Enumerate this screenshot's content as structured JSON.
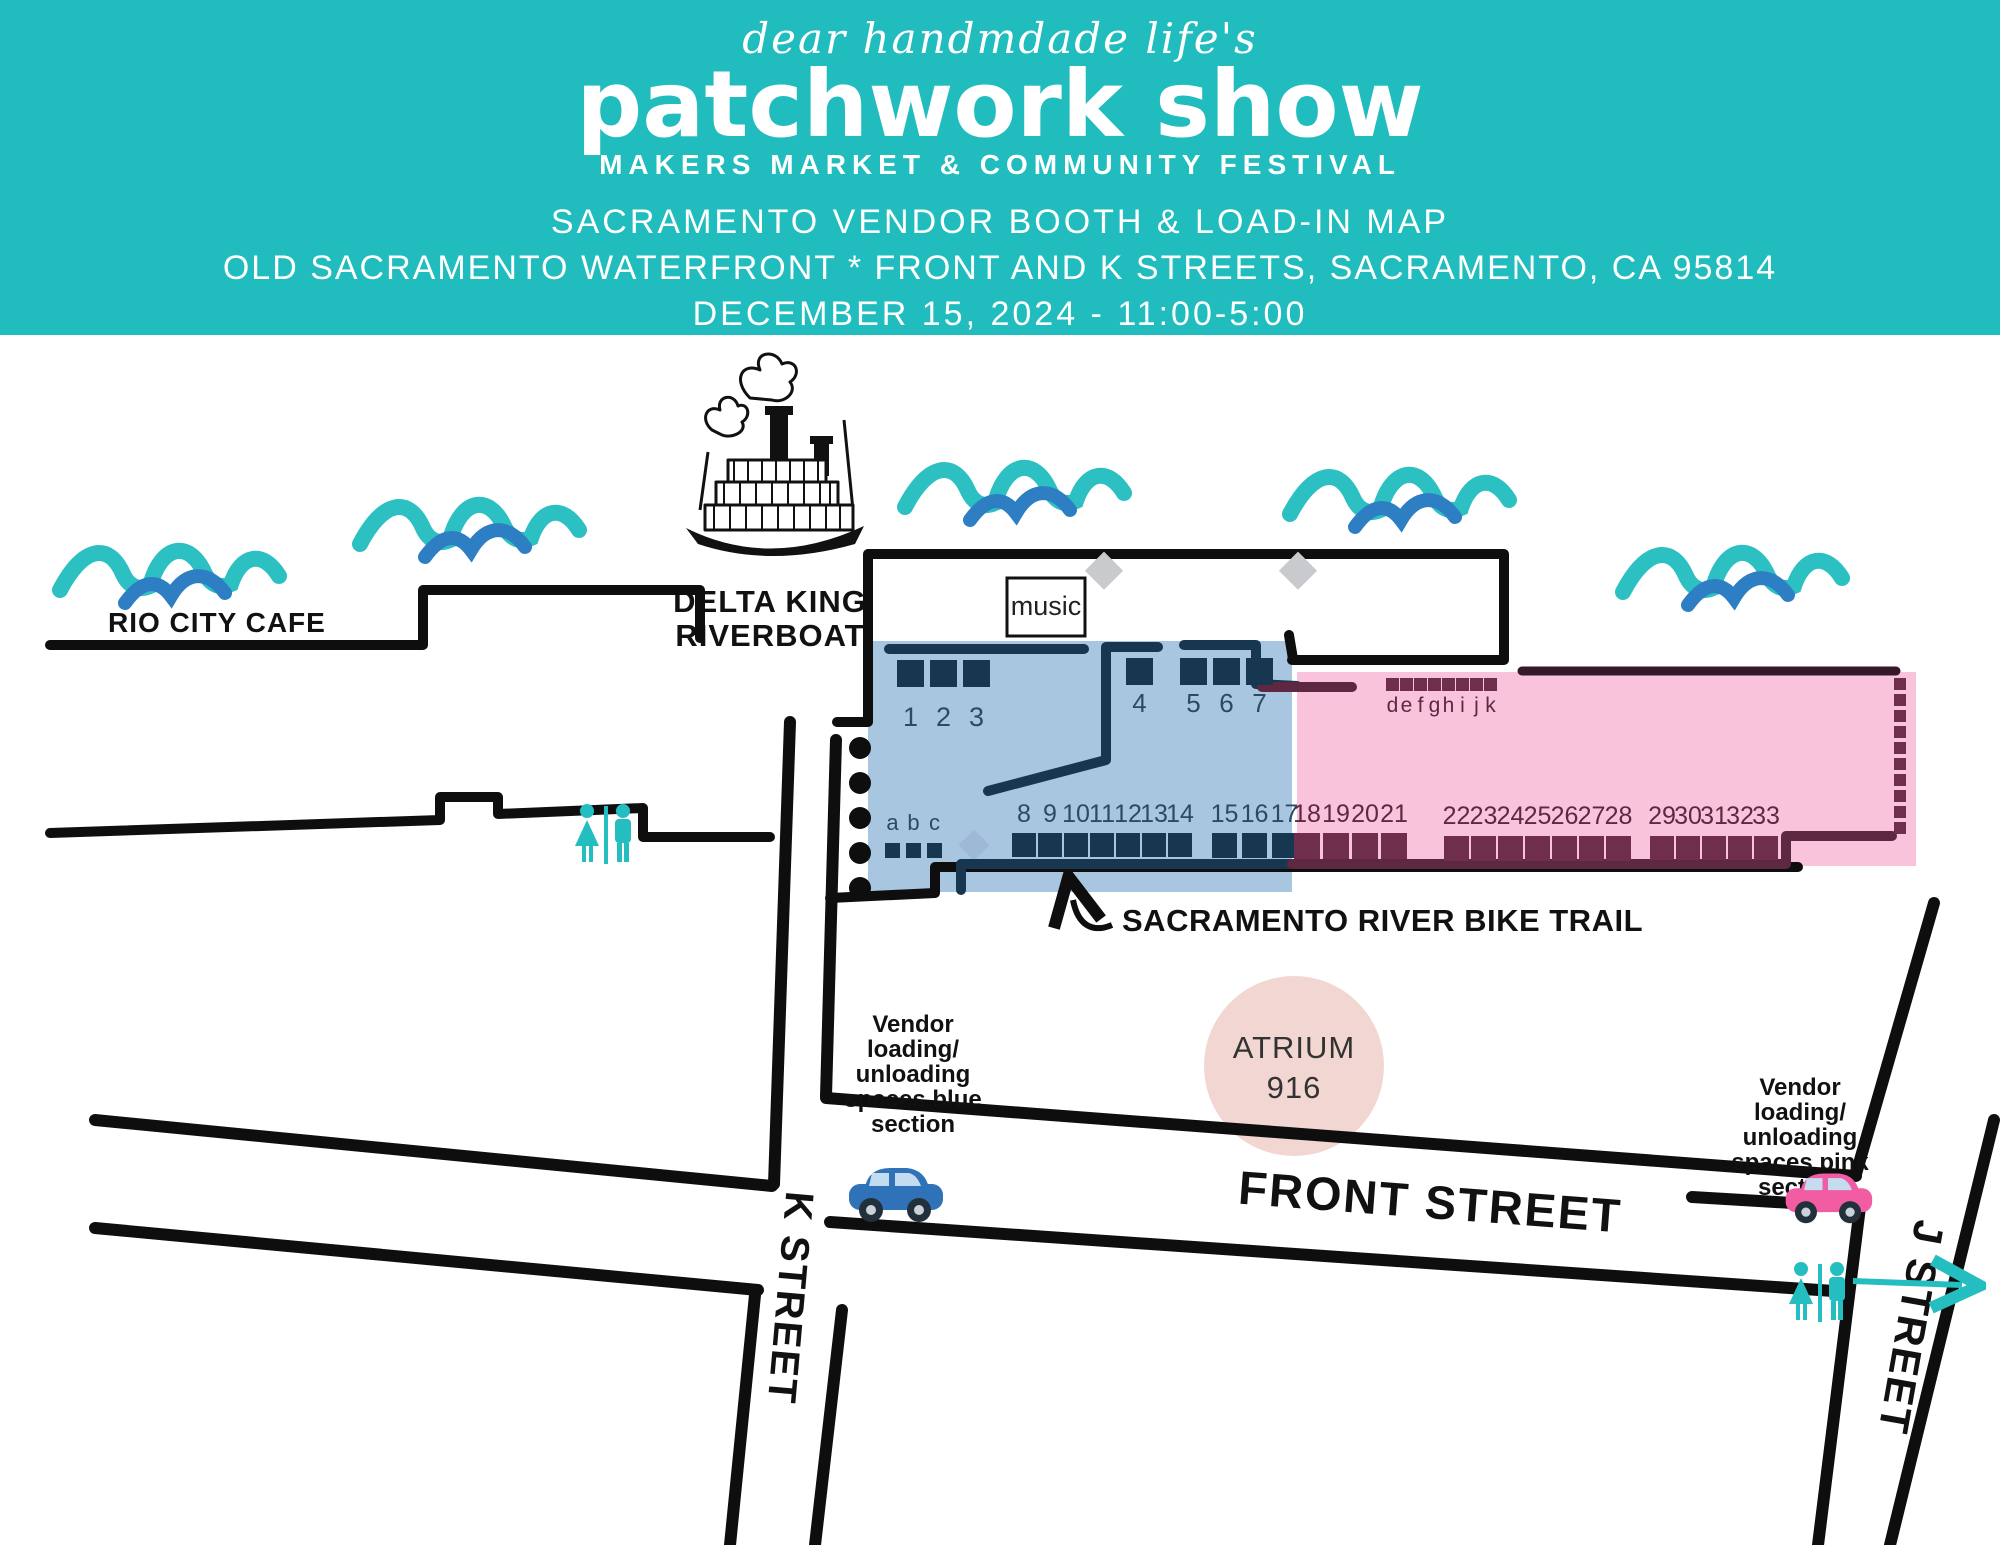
{
  "header": {
    "script_line": "dear handmdade life's",
    "brand": "patchwork show",
    "tagline": "MAKERS MARKET & COMMUNITY FESTIVAL",
    "title": "SACRAMENTO VENDOR BOOTH & LOAD-IN MAP",
    "subtitle": "OLD SACRAMENTO WATERFRONT * FRONT AND K STREETS, SACRAMENTO, CA 95814",
    "datetime": "DECEMBER 15, 2024 - 11:00-5:00"
  },
  "map": {
    "landmarks": {
      "rio_city_cafe": "RIO CITY CAFE",
      "delta_king_line1": "DELTA KING",
      "delta_king_line2": "RIVERBOAT",
      "music": "music",
      "bike_trail": "SACRAMENTO RIVER BIKE TRAIL",
      "atrium_line1": "ATRIUM",
      "atrium_line2": "916"
    },
    "streets": {
      "front": "FRONT STREET",
      "k": "K STREET",
      "j": "J STREET"
    },
    "loading_blue": [
      "Vendor",
      "loading/",
      "unloading",
      "spaces blue",
      "section"
    ],
    "loading_pink": [
      "Vendor",
      "loading/",
      "unloading",
      "spaces pink",
      "section"
    ],
    "booths": {
      "blue_1_3": [
        "1",
        "2",
        "3"
      ],
      "blue_4": [
        "4"
      ],
      "blue_5_7": [
        "5",
        "6",
        "7"
      ],
      "blue_8_14": [
        "8",
        "9",
        "10",
        "11",
        "12",
        "13",
        "14"
      ],
      "blue_15_17": [
        "15",
        "16",
        "17"
      ],
      "pink_18_21": [
        "18",
        "19",
        "20",
        "21"
      ],
      "pink_22_28": [
        "22",
        "23",
        "24",
        "25",
        "26",
        "27",
        "28"
      ],
      "pink_29_33": [
        "29",
        "30",
        "31",
        "32",
        "33"
      ],
      "blue_letters": [
        "a",
        "b",
        "c"
      ],
      "pink_letters": [
        "d",
        "e",
        "f",
        "g",
        "h",
        "i",
        "j",
        "k"
      ]
    }
  },
  "colors": {
    "header_teal": "#20BCBE",
    "wave_teal": "#2CC0C3",
    "wave_blue": "#2E7EC4",
    "section_blue": "#A9C6E1",
    "section_pink": "#F8C3DB",
    "booth_navy": "#17364F",
    "booth_maroon": "#6F2F4C",
    "atrium_pink": "#F2D6D1",
    "restroom_teal": "#25BEC0",
    "car_blue": "#2F72B8",
    "car_pink": "#F25CA2"
  }
}
